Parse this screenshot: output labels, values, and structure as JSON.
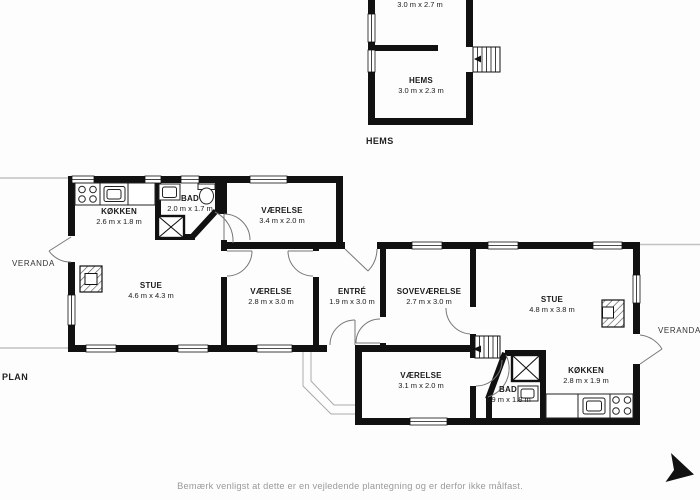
{
  "floorplan": {
    "section_labels": {
      "hems": "HEMS",
      "plan": "PLAN"
    },
    "rooms": {
      "hems_top": {
        "name": "HEMS",
        "dims": "3.0 m x 2.7 m"
      },
      "hems_bottom": {
        "name": "HEMS",
        "dims": "3.0 m x 2.3 m"
      },
      "kokken_left": {
        "name": "KØKKEN",
        "dims": "2.6 m x 1.8 m"
      },
      "bad_top": {
        "name": "BAD",
        "dims": "2.0 m x 1.7 m"
      },
      "vaerelse_top": {
        "name": "VÆRELSE",
        "dims": "3.4 m x 2.0 m"
      },
      "stue_left": {
        "name": "STUE",
        "dims": "4.6 m x 4.3 m"
      },
      "vaerelse_mid": {
        "name": "VÆRELSE",
        "dims": "2.8 m x 3.0 m"
      },
      "entre": {
        "name": "ENTRÉ",
        "dims": "1.9 m x 3.0 m"
      },
      "sovevaerelse": {
        "name": "SOVEVÆRELSE",
        "dims": "2.7 m x 3.0 m"
      },
      "stue_right": {
        "name": "STUE",
        "dims": "4.8 m x 3.8 m"
      },
      "vaerelse_bottom": {
        "name": "VÆRELSE",
        "dims": "3.1 m x 2.0 m"
      },
      "bad_bottom": {
        "name": "BAD",
        "dims": "1.9 m x 1.8 m"
      },
      "kokken_right": {
        "name": "KØKKEN",
        "dims": "2.8 m x 1.9 m"
      }
    },
    "verandas": {
      "left": "VERANDA",
      "right": "VERANDA"
    },
    "disclaimer": "Bemærk venligst at dette er en vejledende plantegning og er derfor ikke målfast.",
    "colors": {
      "wall": "#111111",
      "door_arc": "#777777",
      "veranda_line": "#c2c2c2",
      "label_text": "#1a1a1a",
      "muted_text": "#9a9a9a"
    },
    "icons": [
      "stairs-icon",
      "stove-icon",
      "sink-icon",
      "toilet-icon",
      "shower-icon",
      "fireplace-icon",
      "direction-arrow-icon"
    ]
  }
}
